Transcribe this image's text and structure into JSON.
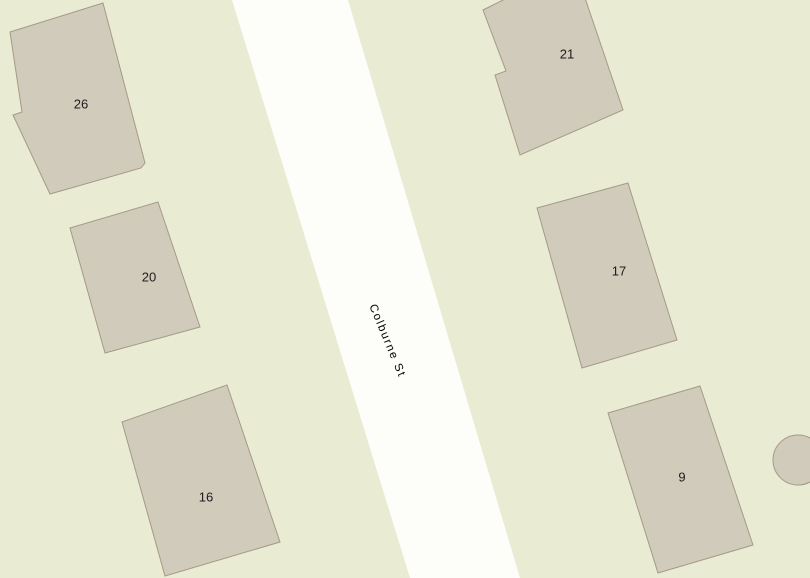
{
  "map": {
    "street": {
      "label": "Colburne St"
    },
    "buildings": [
      {
        "label": "26"
      },
      {
        "label": "20"
      },
      {
        "label": "16"
      },
      {
        "label": "21"
      },
      {
        "label": "17"
      },
      {
        "label": "9"
      }
    ],
    "colors": {
      "background": "#e9ecd2",
      "street-fill": "#fdfdfa",
      "building-fill": "#d1cbbc",
      "building-stroke": "#a49a85",
      "label-color": "#1c1c1c",
      "street-label-color": "#000000"
    }
  }
}
